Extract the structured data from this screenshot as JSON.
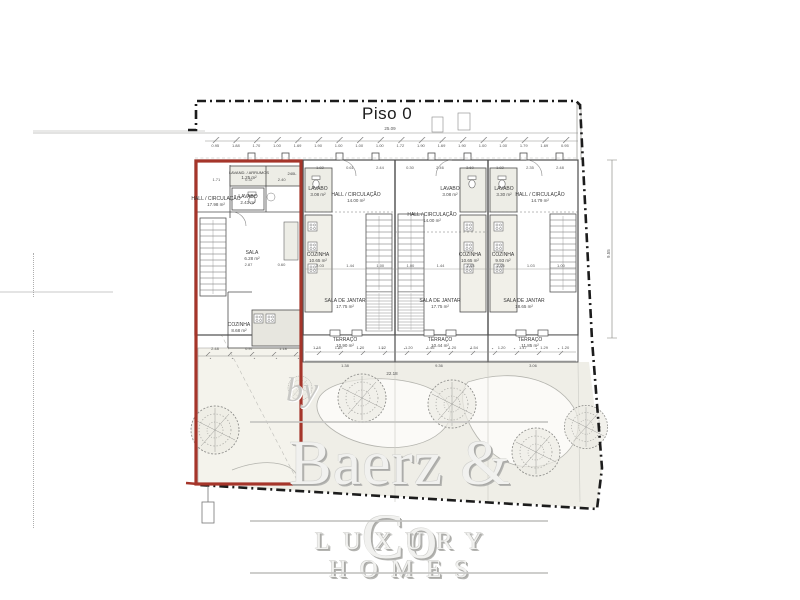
{
  "drawing": {
    "title": "Piso 0",
    "tank_label": "240L",
    "brand": {
      "by": "by",
      "name": "Baerz & Co",
      "tagline": "LUXURY HOMES"
    },
    "rooms": [
      {
        "name": "HALL / CIRCULAÇÃO",
        "area": "17.98 m²"
      },
      {
        "name": "LAVAND. / ARRUMOS",
        "area": "1.25 m²"
      },
      {
        "name": "LAVABO",
        "area": "2.43 m²"
      },
      {
        "name": "SALA",
        "area": "6.28 m²"
      },
      {
        "name": "COZINHA",
        "area": "8.68 m²"
      },
      {
        "name": "LAVABO",
        "area": "3.08 m²"
      },
      {
        "name": "HALL / CIRCULAÇÃO",
        "area": "14.00 m²"
      },
      {
        "name": "COZINHA",
        "area": "10.65 m²"
      },
      {
        "name": "SALA DE JANTAR",
        "area": "17.75 m²"
      },
      {
        "name": "TERRAÇO",
        "area": "10.90 m²"
      },
      {
        "name": "HALL / CIRCULAÇÃO",
        "area": "14.00 m²"
      },
      {
        "name": "LAVABO",
        "area": "3.08 m²"
      },
      {
        "name": "COZINHA",
        "area": "10.65 m²"
      },
      {
        "name": "SALA DE JANTAR",
        "area": "17.75 m²"
      },
      {
        "name": "TERRAÇO",
        "area": "10.44 m²"
      },
      {
        "name": "LAVABO",
        "area": "3.30 m²"
      },
      {
        "name": "HALL / CIRCULAÇÃO",
        "area": "14.79 m²"
      },
      {
        "name": "COZINHA",
        "area": "9.93 m²"
      },
      {
        "name": "SALA DE JANTAR",
        "area": "18.65 m²"
      },
      {
        "name": "TERRAÇO",
        "area": "11.85 m²"
      }
    ],
    "dims": {
      "overall_top": "25.09",
      "right_vertical": "9.55",
      "overall_bottom": "22.18",
      "top_chain": [
        "0.95",
        "1.88",
        "1.70",
        "1.00",
        "1.69",
        "1.90",
        "1.00",
        "1.00",
        "1.00",
        "1.72",
        "1.90",
        "1.69",
        "1.90",
        "1.00",
        "1.00",
        "1.79",
        "1.69",
        "0.95"
      ],
      "door_chain": [
        "1.82",
        "0.61",
        "2.44",
        "0.30",
        "2.46",
        "3.60",
        "1.82",
        "2.35",
        "2.48"
      ],
      "unit1_top": [
        "1.71",
        "0.37",
        "2.40"
      ],
      "unit1_sala": [
        "2.87",
        "0.60"
      ],
      "unit1_bottom": [
        "2.48",
        "0.97",
        "1.18"
      ],
      "mid_chain": [
        "2.03",
        "1.44",
        "1.00",
        "1.00",
        "1.44",
        "2.03",
        "2.05",
        "1.03",
        "1.00"
      ],
      "terrace2": [
        "1.18",
        "1.49",
        "1.20",
        "1.52"
      ],
      "terrace3": [
        "1.20",
        "1.46",
        "1.20",
        "1.54"
      ],
      "terrace4": [
        "1.20",
        "1.47",
        "1.29",
        "1.20"
      ],
      "terrace_sub": [
        "1.38",
        "9.36",
        "3.06"
      ]
    },
    "colors": {
      "highlight_red": "#a5352a",
      "boundary_black": "#1c1c1c",
      "wall_gray": "#4d4d4d"
    }
  }
}
